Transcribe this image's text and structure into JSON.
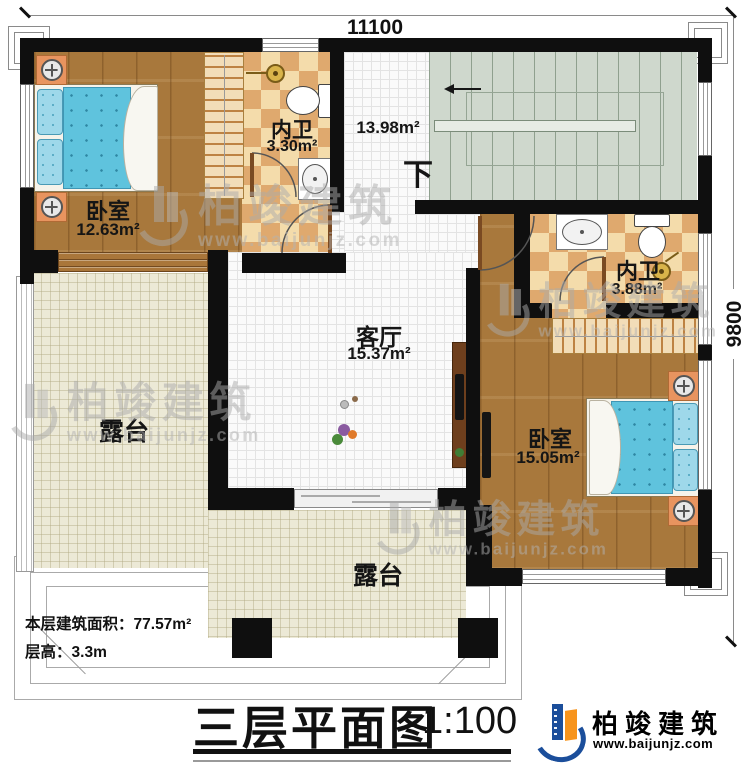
{
  "dimensions": {
    "top": "11100",
    "right": "9800"
  },
  "rooms": {
    "bedroom1": {
      "label": "卧室",
      "area": "12.63m²"
    },
    "bathroom1": {
      "label": "内卫",
      "area": "3.30m²"
    },
    "hall": {
      "area": "13.98m²",
      "stair_direction": "下"
    },
    "living": {
      "label": "客厅",
      "area": "15.37m²"
    },
    "bathroom2": {
      "label": "内卫",
      "area": "3.88m²"
    },
    "bedroom2": {
      "label": "卧室",
      "area": "15.05m²"
    },
    "terrace_left": {
      "label": "露台"
    },
    "terrace_bottom": {
      "label": "露台"
    }
  },
  "info": {
    "floor_area_label": "本层建筑面积：",
    "floor_area_value": "77.57m²",
    "height_label": "层高：",
    "height_value": "3.3m"
  },
  "titleblock": {
    "title": "三层平面图",
    "scale": "1:100"
  },
  "brand": {
    "name": "柏竣建筑",
    "website": "www.baijunjz.com"
  },
  "watermark": {
    "name": "柏竣建筑",
    "website": "www.baijunjz.com"
  },
  "colors": {
    "wall": "#0f0f0f",
    "wood_floor": "#a8783c",
    "bath_tile_light": "#f4dcab",
    "bath_tile_dark": "#dfa96e",
    "stair": "#cfd8cd",
    "terrace": "#ece9d6",
    "bed_blue": "#5fc3dd",
    "nightstand_orange": "#e8945f",
    "logo_blue": "#1b4e9b",
    "logo_orange": "#f7941d"
  }
}
